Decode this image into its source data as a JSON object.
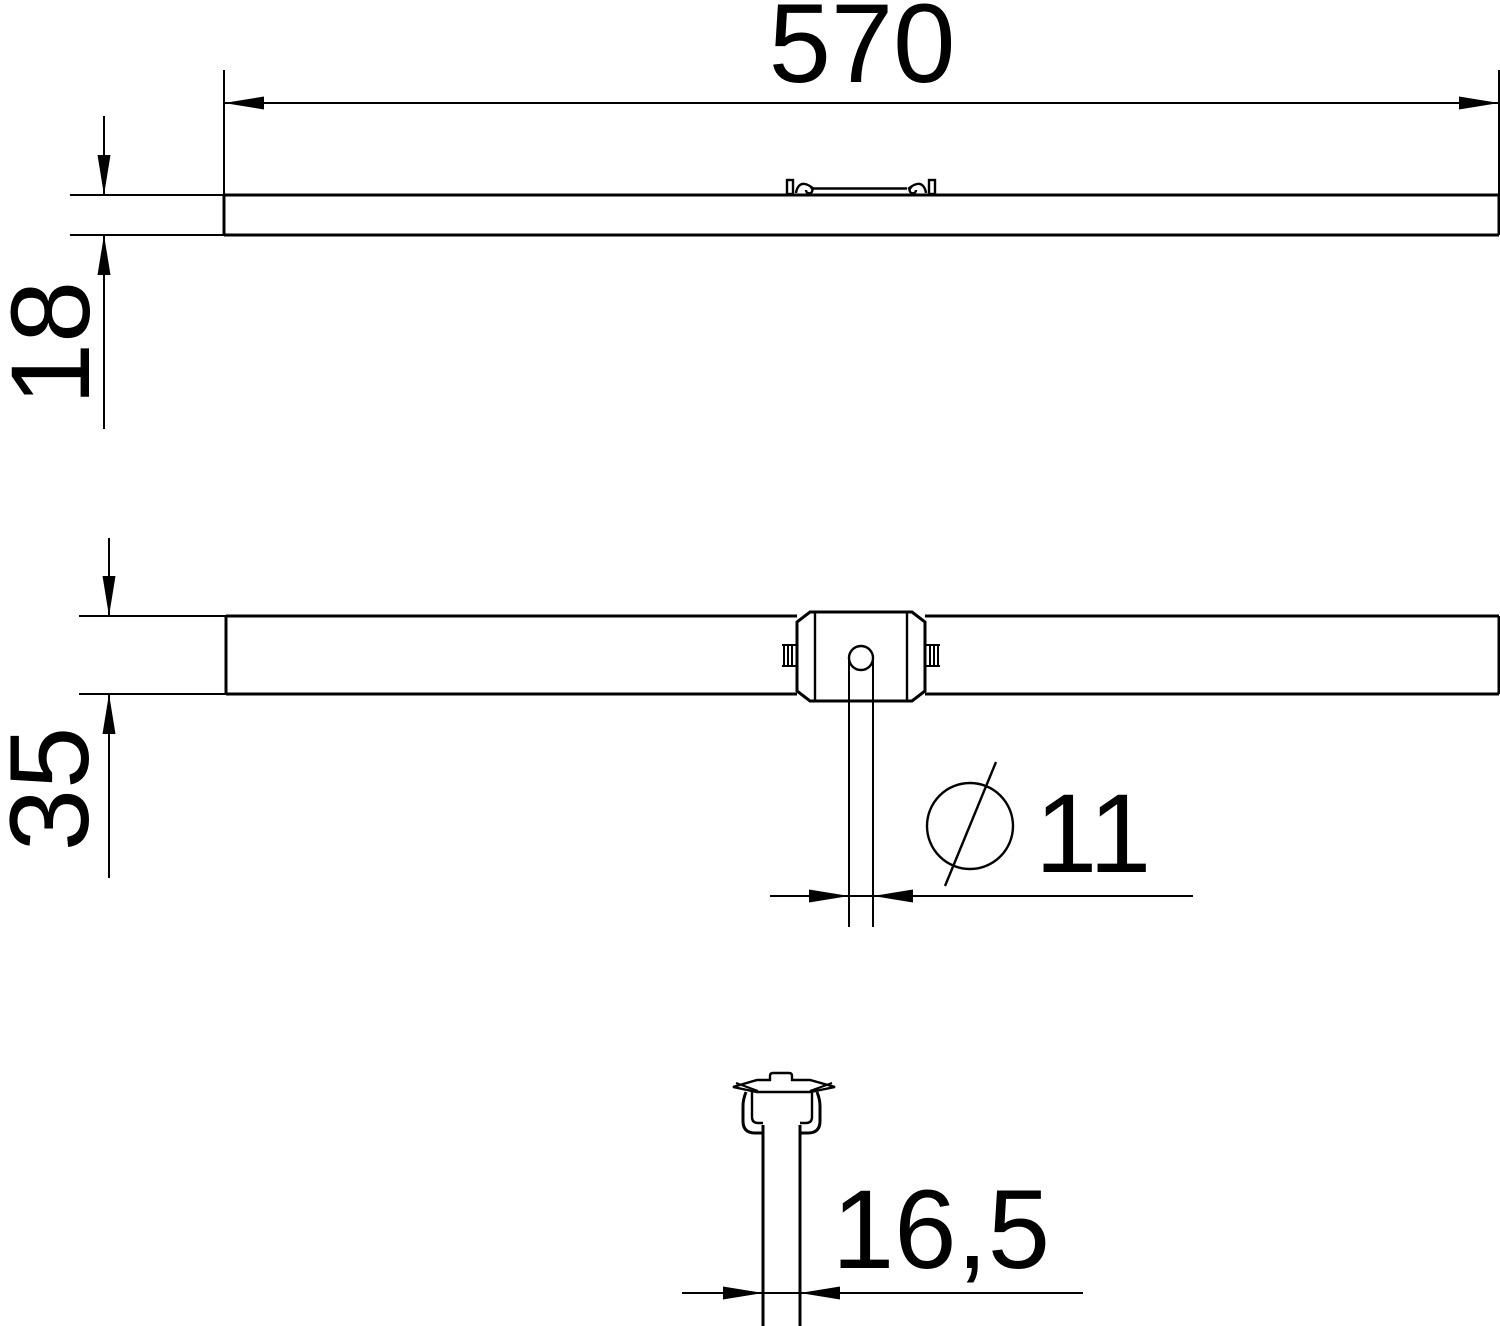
{
  "page": {
    "background": "#ffffff",
    "line_color": "#000000"
  },
  "dimensions": {
    "length": {
      "label": "570"
    },
    "profile_height": {
      "label": "18"
    },
    "profile_depth": {
      "label": "35"
    },
    "hole_diameter": {
      "label": "11",
      "symbol": "diameter-slashed-circle"
    },
    "rod_width": {
      "label": "16,5"
    }
  }
}
